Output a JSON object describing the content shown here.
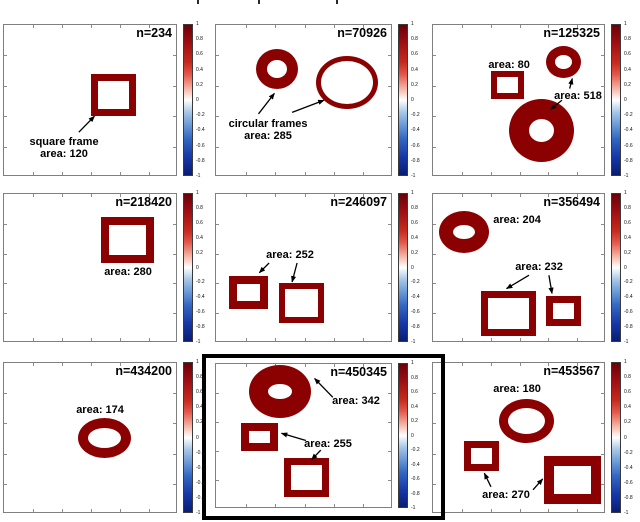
{
  "colors": {
    "shape_red": "#8b0000",
    "annotation_text": "#000000",
    "highlight_border": "#000000"
  },
  "chart_data": {
    "type": "heatmap",
    "layout": "3x3 grid of binary shape-image panels, each with its own diverging red-blue colorbar; bottom-middle panel outlined in bold black",
    "colorbar": {
      "range": [
        -1,
        1
      ],
      "ticks": [
        "1",
        "0.8",
        "0.6",
        "0.4",
        "0.2",
        "0",
        "-0.2",
        "-0.4",
        "-0.6",
        "-0.8",
        "-1"
      ]
    },
    "panels": [
      {
        "n": "n=234",
        "highlighted": false,
        "shapes": [
          {
            "kind": "square-frame",
            "x": 0.5,
            "y": 0.322,
            "w": 0.259,
            "h": 0.276,
            "border": 7
          }
        ],
        "annotations": [
          {
            "lines": [
              "square frame",
              "area: 120"
            ],
            "cx": 0.345,
            "top": 0.73,
            "arrows": [
              {
                "x1": 0.43,
                "y1": 0.705,
                "x2": 0.52,
                "y2": 0.6
              }
            ]
          }
        ]
      },
      {
        "n": "n=70926",
        "highlighted": false,
        "shapes": [
          {
            "kind": "circular-frame",
            "x": 0.226,
            "y": 0.158,
            "w": 0.237,
            "h": 0.263,
            "border": 11
          },
          {
            "kind": "circular-frame",
            "x": 0.565,
            "y": 0.204,
            "w": 0.35,
            "h": 0.349,
            "border": 5
          }
        ],
        "annotations": [
          {
            "lines": [
              "circular frames",
              "area: 285"
            ],
            "cx": 0.294,
            "top": 0.61,
            "arrows": [
              {
                "x1": 0.24,
                "y1": 0.585,
                "x2": 0.33,
                "y2": 0.45
              },
              {
                "x1": 0.43,
                "y1": 0.575,
                "x2": 0.61,
                "y2": 0.495
              }
            ]
          }
        ]
      },
      {
        "n": "n=125325",
        "highlighted": false,
        "shapes": [
          {
            "kind": "square-frame",
            "x": 0.335,
            "y": 0.303,
            "w": 0.191,
            "h": 0.184,
            "border": 6
          },
          {
            "kind": "circular-frame",
            "x": 0.653,
            "y": 0.138,
            "w": 0.202,
            "h": 0.211,
            "border": 9
          },
          {
            "kind": "circular-frame",
            "x": 0.439,
            "y": 0.487,
            "w": 0.376,
            "h": 0.414,
            "border": 20
          }
        ],
        "annotations": [
          {
            "lines": [
              "area: 80"
            ],
            "cx": 0.44,
            "top": 0.224,
            "arrows": []
          },
          {
            "lines": [
              "area: 518"
            ],
            "cx": 0.838,
            "top": 0.428,
            "arrows": [
              {
                "x1": 0.79,
                "y1": 0.418,
                "x2": 0.805,
                "y2": 0.352
              },
              {
                "x1": 0.745,
                "y1": 0.495,
                "x2": 0.68,
                "y2": 0.555
              }
            ]
          }
        ]
      },
      {
        "n": "n=218420",
        "highlighted": false,
        "shapes": [
          {
            "kind": "square-frame",
            "x": 0.557,
            "y": 0.154,
            "w": 0.305,
            "h": 0.309,
            "border": 8
          }
        ],
        "annotations": [
          {
            "lines": [
              "area: 280"
            ],
            "cx": 0.713,
            "top": 0.483,
            "arrows": []
          }
        ]
      },
      {
        "n": "n=246097",
        "highlighted": false,
        "shapes": [
          {
            "kind": "square-frame",
            "x": 0.073,
            "y": 0.55,
            "w": 0.22,
            "h": 0.221,
            "border": 8
          },
          {
            "kind": "square-frame",
            "x": 0.356,
            "y": 0.597,
            "w": 0.254,
            "h": 0.268,
            "border": 6
          }
        ],
        "annotations": [
          {
            "lines": [
              "area: 252"
            ],
            "cx": 0.418,
            "top": 0.369,
            "arrows": [
              {
                "x1": 0.3,
                "y1": 0.463,
                "x2": 0.245,
                "y2": 0.528
              },
              {
                "x1": 0.458,
                "y1": 0.463,
                "x2": 0.43,
                "y2": 0.59
              }
            ]
          }
        ]
      },
      {
        "n": "n=356494",
        "highlighted": false,
        "shapes": [
          {
            "kind": "circular-frame",
            "x": 0.035,
            "y": 0.114,
            "w": 0.289,
            "h": 0.282,
            "border": 14
          },
          {
            "kind": "square-frame",
            "x": 0.277,
            "y": 0.651,
            "w": 0.318,
            "h": 0.302,
            "border": 7
          },
          {
            "kind": "square-frame",
            "x": 0.653,
            "y": 0.685,
            "w": 0.202,
            "h": 0.201,
            "border": 7
          }
        ],
        "annotations": [
          {
            "lines": [
              "area: 204"
            ],
            "cx": 0.486,
            "top": 0.134,
            "arrows": []
          },
          {
            "lines": [
              "area: 232"
            ],
            "cx": 0.613,
            "top": 0.45,
            "arrows": [
              {
                "x1": 0.555,
                "y1": 0.545,
                "x2": 0.425,
                "y2": 0.635
              },
              {
                "x1": 0.67,
                "y1": 0.545,
                "x2": 0.688,
                "y2": 0.668
              }
            ]
          }
        ]
      },
      {
        "n": "n=434200",
        "highlighted": false,
        "shapes": [
          {
            "kind": "circular-frame",
            "x": 0.425,
            "y": 0.364,
            "w": 0.305,
            "h": 0.265,
            "border": 10
          }
        ],
        "annotations": [
          {
            "lines": [
              "area: 174"
            ],
            "cx": 0.552,
            "top": 0.272,
            "arrows": []
          }
        ]
      },
      {
        "n": "n=450345",
        "highlighted": true,
        "shapes": [
          {
            "kind": "circular-frame",
            "x": 0.186,
            "y": 0.007,
            "w": 0.35,
            "h": 0.364,
            "border": 19
          },
          {
            "kind": "square-frame",
            "x": 0.141,
            "y": 0.404,
            "w": 0.209,
            "h": 0.199,
            "border": 8
          },
          {
            "kind": "square-frame",
            "x": 0.384,
            "y": 0.649,
            "w": 0.254,
            "h": 0.265,
            "border": 7
          }
        ],
        "annotations": [
          {
            "lines": [
              "area: 342"
            ],
            "cx": 0.791,
            "top": 0.212,
            "arrows": [
              {
                "x1": 0.66,
                "y1": 0.23,
                "x2": 0.557,
                "y2": 0.1
              }
            ]
          },
          {
            "lines": [
              "area: 255"
            ],
            "cx": 0.633,
            "top": 0.51,
            "arrows": [
              {
                "x1": 0.508,
                "y1": 0.528,
                "x2": 0.37,
                "y2": 0.478
              },
              {
                "x1": 0.592,
                "y1": 0.594,
                "x2": 0.54,
                "y2": 0.66
              }
            ]
          }
        ]
      },
      {
        "n": "n=453567",
        "highlighted": false,
        "shapes": [
          {
            "kind": "circular-frame",
            "x": 0.382,
            "y": 0.238,
            "w": 0.318,
            "h": 0.291,
            "border": 9
          },
          {
            "kind": "square-frame",
            "x": 0.179,
            "y": 0.517,
            "w": 0.202,
            "h": 0.199,
            "border": 7
          },
          {
            "kind": "square-frame",
            "x": 0.642,
            "y": 0.616,
            "w": 0.329,
            "h": 0.318,
            "border": 10
          }
        ],
        "annotations": [
          {
            "lines": [
              "area: 180"
            ],
            "cx": 0.486,
            "top": 0.132,
            "arrows": []
          },
          {
            "lines": [
              "area: 270"
            ],
            "cx": 0.422,
            "top": 0.834,
            "arrows": [
              {
                "x1": 0.335,
                "y1": 0.82,
                "x2": 0.297,
                "y2": 0.73
              },
              {
                "x1": 0.578,
                "y1": 0.84,
                "x2": 0.634,
                "y2": 0.768
              }
            ]
          }
        ]
      }
    ]
  }
}
